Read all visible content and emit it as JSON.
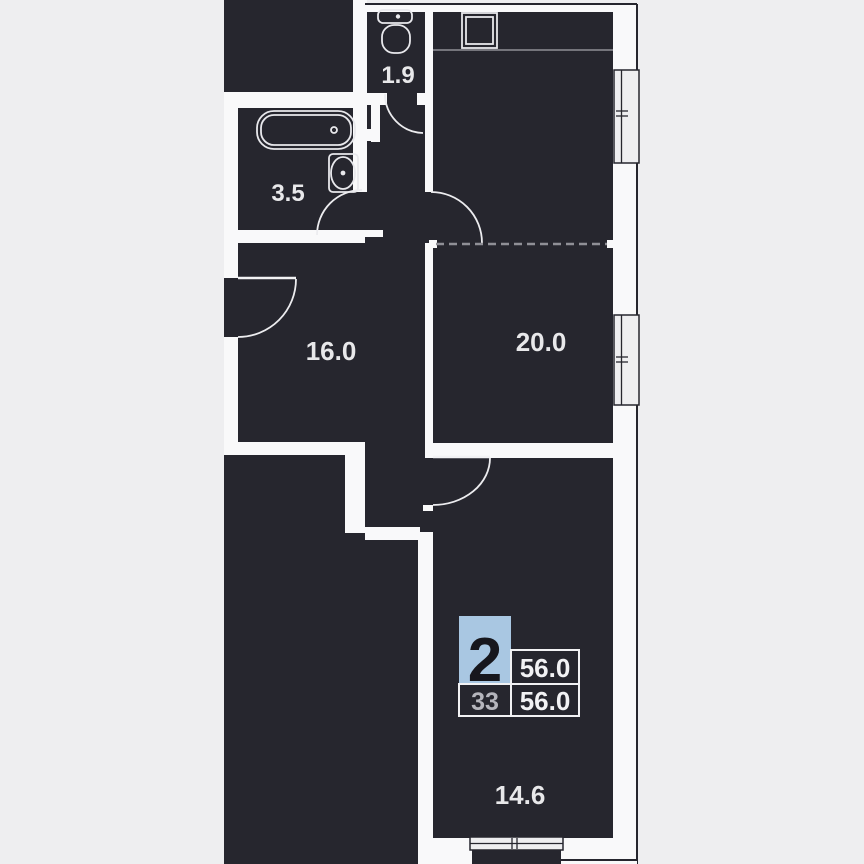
{
  "plan": {
    "title": "2-room apartment floor plan",
    "rooms": [
      {
        "id": "wc",
        "name": "toilet",
        "area_label": "1.9"
      },
      {
        "id": "bathroom",
        "name": "bathroom",
        "area_label": "3.5"
      },
      {
        "id": "hall-room",
        "name": "room",
        "area_label": "16.0"
      },
      {
        "id": "kitchen-living",
        "name": "kitchen-living",
        "area_label": "20.0"
      },
      {
        "id": "bedroom",
        "name": "bedroom",
        "area_label": "14.6"
      }
    ],
    "badge": {
      "rooms_count": "2",
      "total_area": "56.0",
      "floor": "33",
      "area": "56.0"
    },
    "fixtures": [
      "toilet",
      "bathtub",
      "washing-machine",
      "kitchen-sink"
    ],
    "colors": {
      "background": "#eeeef0",
      "floor_dark": "#26262e",
      "wall_light": "#f9f9fa",
      "badge_blue": "#a9c7e2",
      "label_text": "#e8e8ea",
      "muted_text": "#b5b5bc",
      "dash_gray": "#8f8f96"
    }
  }
}
